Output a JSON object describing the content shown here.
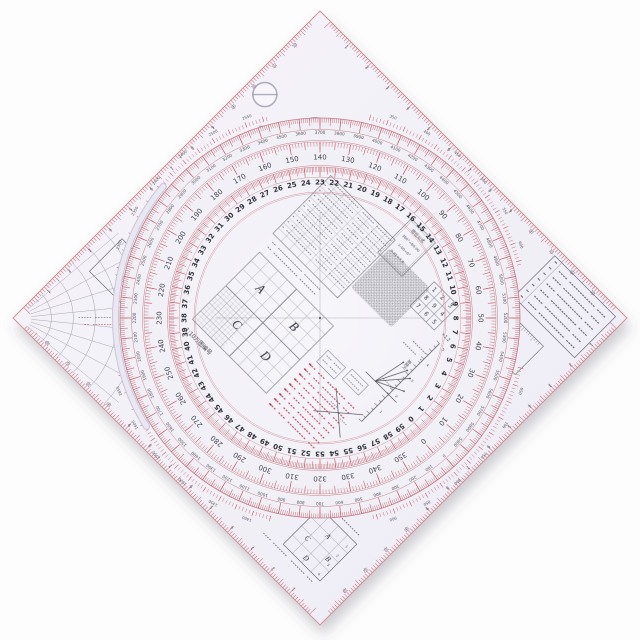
{
  "photo": {
    "background": "#fdfdfd",
    "plate_color_light": "#f6f5fa",
    "plate_color_dark": "#edebf4",
    "disc_color_center": "#f7f6fb",
    "disc_color_edge": "#f0eff6",
    "tick_red": "#c4606a",
    "red_text": "#bf4750",
    "ink": "#3c3c46",
    "faint_line": "#9a9aa4"
  },
  "protractor": {
    "outer_mil_scale": {
      "units": "mils",
      "min": 0,
      "max": 6000,
      "label_step": 100,
      "top_value": 3700,
      "direction": "cw",
      "visible_labels_sample": [
        3300,
        3400,
        3500,
        3600,
        3700,
        3800,
        3900,
        4000
      ]
    },
    "degree_scale": {
      "units": "degrees",
      "min": 0,
      "max": 360,
      "label_step": 10,
      "top_value": 140,
      "direction": "ccw",
      "visible_labels_sample": [
        110,
        120,
        130,
        140,
        150,
        160,
        170
      ]
    },
    "unit60_scale": {
      "units": "mil-hundreds",
      "min": 0,
      "max": 60,
      "label_step": 1,
      "top_value": 23,
      "direction": "ccw",
      "visible_labels_sample": [
        17,
        18,
        19,
        20,
        21,
        22,
        23,
        24,
        25,
        26,
        27,
        28,
        29
      ]
    }
  },
  "margin_arcs": {
    "top_right": [
      350,
      400,
      450,
      500,
      550,
      600
    ],
    "bottom_right": [
      650,
      700,
      750,
      800,
      850,
      900
    ],
    "bottom_left": [
      1400,
      1450,
      1500,
      1550,
      1600,
      1650
    ],
    "top_left": [
      2300,
      2350,
      2400,
      2450,
      2500,
      2550
    ]
  },
  "center": {
    "grid_letters": [
      "A",
      "B",
      "C",
      "D"
    ],
    "map_code_label": "1:10万图编号",
    "mil_formula": {
      "title": "密位公式",
      "lines": [
        "360°=60-00",
        "1-00=6°",
        "0-01≈3.6′"
      ]
    },
    "speed_ruler": {
      "label": "速度尺",
      "multiplier": "×1.2",
      "tick_values": [
        1,
        2,
        3,
        4,
        5
      ]
    },
    "number_grid": [
      [
        "1",
        "2",
        "3"
      ],
      [
        "8",
        "9",
        "4"
      ],
      [
        "7",
        "6",
        "5"
      ]
    ]
  },
  "corners": {
    "top_shapes": [
      "slashed-circle",
      "square",
      "circle",
      "diamond",
      "triangle",
      "small-triangle"
    ],
    "left_scale_box": "1:5万",
    "right_scale_box": "1:2.5万",
    "bottom_grid_letters": [
      "A",
      "B",
      "C",
      "D"
    ]
  },
  "edge_rulers": {
    "cm_labels": [
      1,
      2,
      3,
      4,
      5,
      6,
      7,
      8,
      9,
      10,
      11,
      12,
      13
    ]
  }
}
